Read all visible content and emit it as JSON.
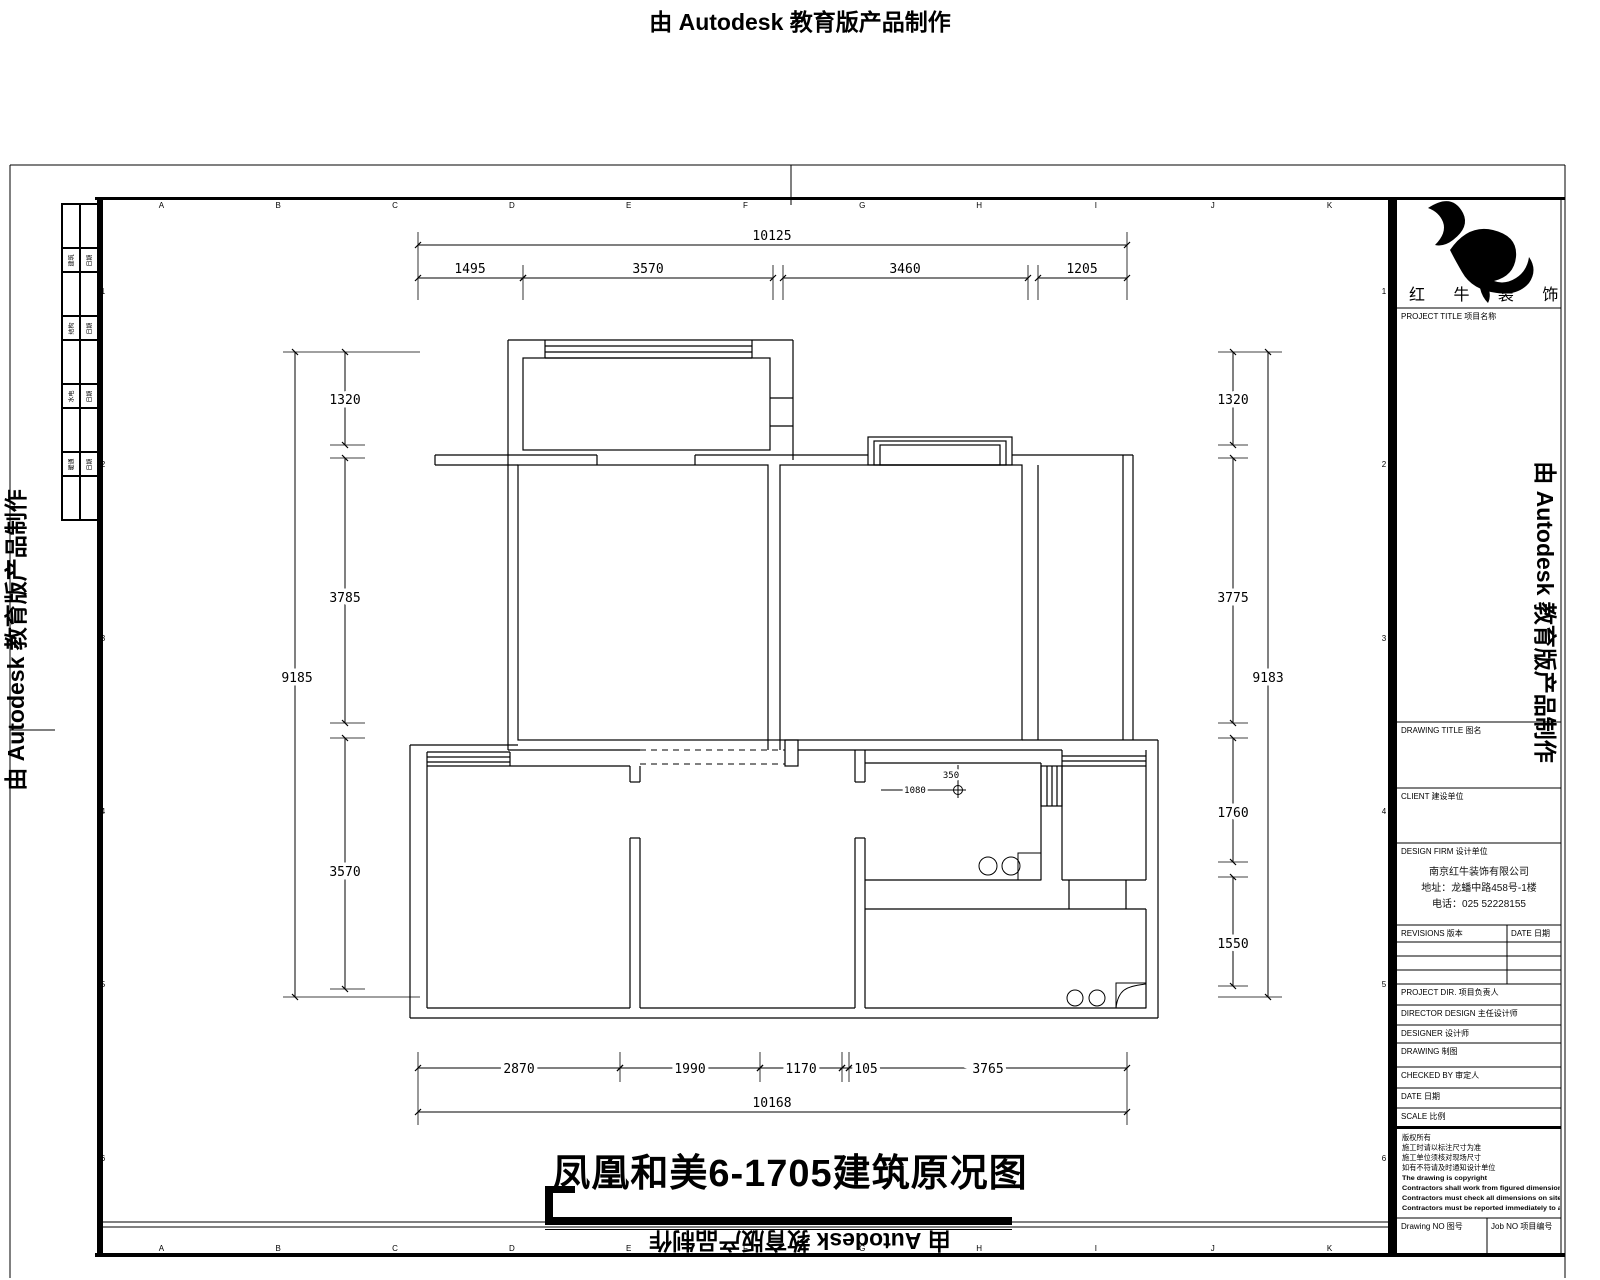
{
  "watermarks": {
    "top": "由 Autodesk 教育版产品制作",
    "left": "由 Autodesk 教育版产品制作",
    "right": "由 Autodesk 教育版产品制作",
    "bottom": "由 Autodesk 教育版产品制作"
  },
  "drawing_title": "凤凰和美6-1705建筑原况图",
  "grid": {
    "columns": [
      "A",
      "B",
      "C",
      "D",
      "E",
      "F",
      "G",
      "H",
      "I",
      "J",
      "K"
    ],
    "rows": [
      "1",
      "2",
      "3",
      "4",
      "5",
      "6"
    ]
  },
  "left_strip": {
    "rows": [
      [
        "建筑",
        "日期"
      ],
      [
        "结构",
        "日期"
      ],
      [
        "水电",
        "日期"
      ],
      [
        "暖通",
        "日期"
      ]
    ]
  },
  "dimensions": {
    "top": {
      "overall": "10125",
      "segments": [
        "1495",
        "3570",
        "3460",
        "1205"
      ]
    },
    "bottom": {
      "overall": "10168",
      "segments": [
        "2870",
        "1990",
        "1170",
        "105",
        "3765"
      ]
    },
    "left": {
      "overall": "9185",
      "segments": [
        "1320",
        "3785",
        "3570"
      ]
    },
    "right": {
      "overall": "9183",
      "segments": [
        "1320",
        "3775",
        "1760",
        "1550"
      ]
    },
    "interior": {
      "drain_offset": "350",
      "drain_distance": "1080"
    }
  },
  "title_block": {
    "brand_name": "红 牛 装 饰",
    "fields": {
      "project_title": "PROJECT TITLE 项目名称",
      "drawing_title": "DRAWING TITLE 图名",
      "client": "CLIENT 建设单位",
      "design_firm": "DESIGN FIRM 设计单位",
      "company_name": "南京红牛装饰有限公司",
      "company_address": "地址：龙蟠中路458号-1楼",
      "company_phone": "电话：025 52228155",
      "revisions": "REVISIONS 版本",
      "date_col": "DATE 日期",
      "project_dir": "PROJECT DIR. 项目负责人",
      "director_design": "DIRECTOR DESIGN 主任设计师",
      "designer": "DESIGNER 设计师",
      "drawing": "DRAWING 制图",
      "checked_by": "CHECKED BY 审定人",
      "date": "DATE 日期",
      "scale": "SCALE 比例",
      "drawing_no": "Drawing NO 图号",
      "job_no": "Job NO 项目编号"
    },
    "notes": [
      "版权所有",
      "施工时请以标注尺寸为准",
      "施工单位须核对现场尺寸",
      "如有不符请及时通知设计单位",
      "The drawing is copyright",
      "Contractors shall work from figured dimensions only",
      "Contractors must check all dimensions on site",
      "Contractors must be reported immediately to architects"
    ]
  },
  "colors": {
    "line": "#000000",
    "paper": "#ffffff"
  }
}
